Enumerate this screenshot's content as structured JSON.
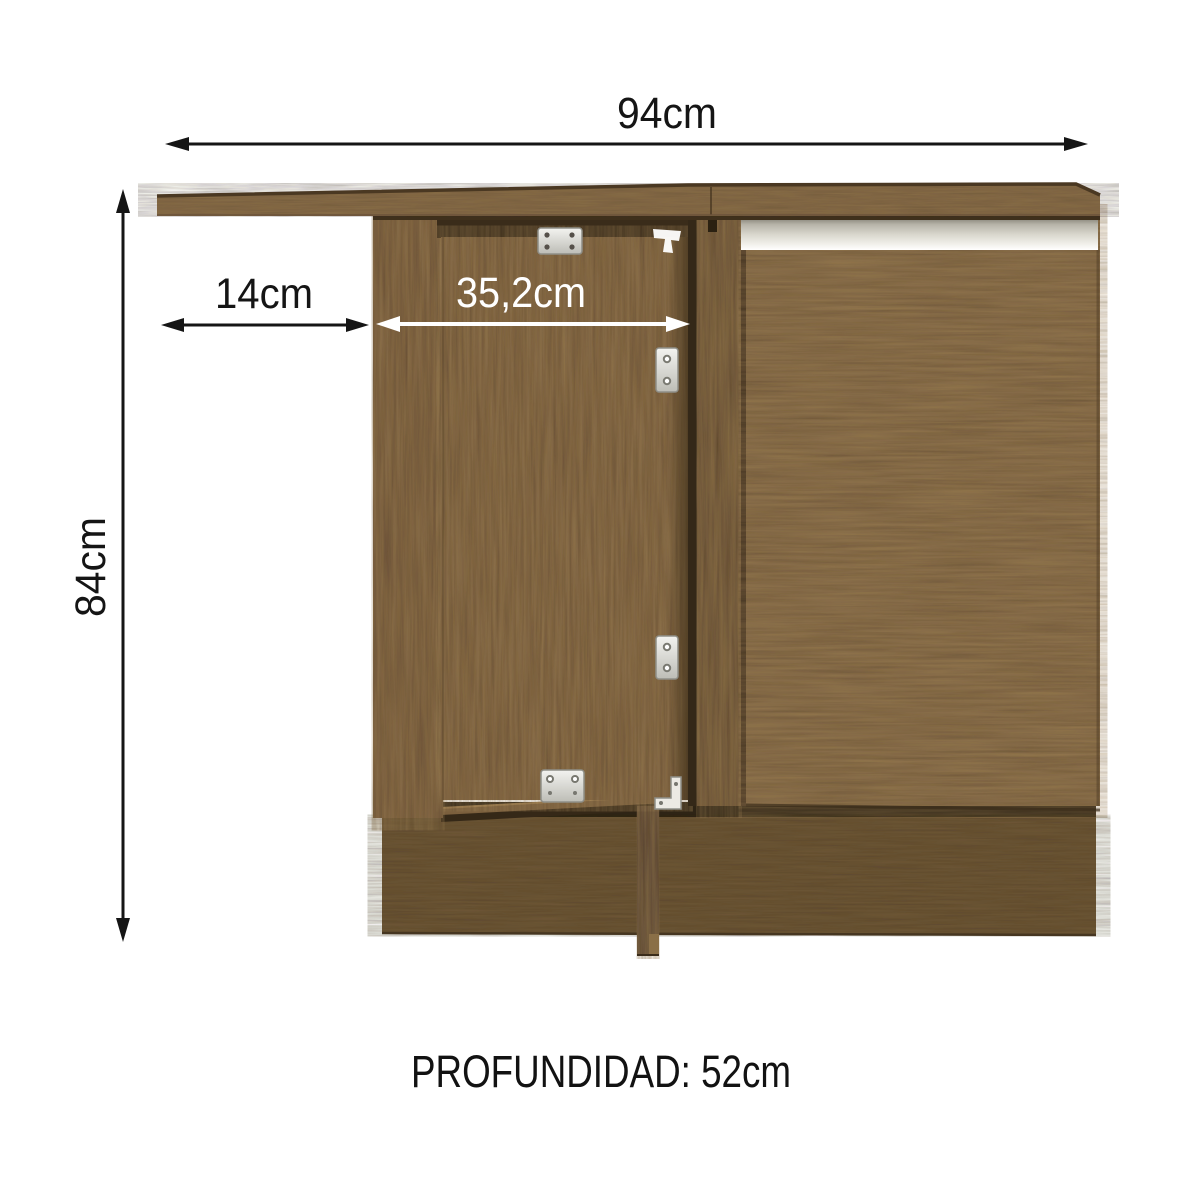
{
  "diagram": {
    "labels": {
      "width_top": "94cm",
      "height_left": "84cm",
      "offset_left": "14cm",
      "door_width": "35,2cm",
      "depth": "PROFUNDIDAD: 52cm"
    },
    "colors": {
      "background": "#ffffff",
      "annotation_black": "#151515",
      "annotation_white": "#ffffff",
      "wood_medium": "#7d6244",
      "wood_dark": "#5a4530",
      "countertop_wood": "#8a6e48",
      "plinth_wood": "#6f5839",
      "handle_metal": "#d9d7cd",
      "hinge_metal": "#dededa"
    }
  }
}
